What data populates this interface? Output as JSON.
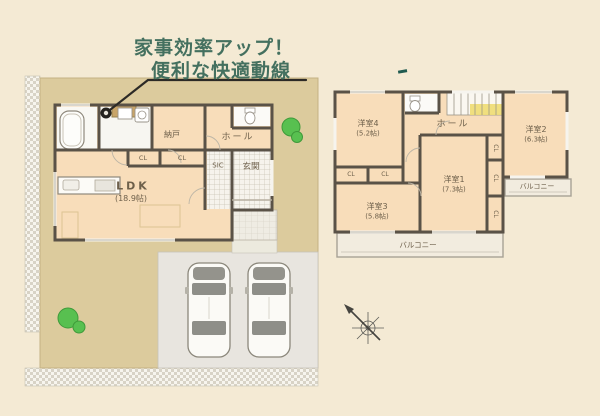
{
  "callout": {
    "line1": "家事効率アップ！",
    "line2": "便利な快適動線"
  },
  "floor1": {
    "rooms": {
      "ldk": {
        "label": "LDK",
        "size": "(18.9帖)"
      },
      "nando": {
        "label": "納戸"
      },
      "hall": {
        "label": "ホール"
      },
      "sic": {
        "label": "SIC"
      },
      "genkan": {
        "label": "玄関"
      },
      "closet_a": "CL",
      "closet_b": "CL"
    },
    "parking_cars": 2
  },
  "floor2": {
    "rooms": {
      "room1": {
        "label": "洋室1",
        "size": "(7.3帖)"
      },
      "room2": {
        "label": "洋室2",
        "size": "(6.3帖)"
      },
      "room3": {
        "label": "洋室3",
        "size": "(5.8帖)"
      },
      "room4": {
        "label": "洋室4",
        "size": "(5.2帖)"
      },
      "hall": {
        "label": "ホール"
      },
      "balcony_south": "バルコニー",
      "balcony_east": "バルコニー",
      "closets": [
        "CL",
        "CL",
        "CL",
        "CL",
        "CL"
      ]
    }
  },
  "colors": {
    "background": "#f4ead4",
    "site_ground": "#dccb9d",
    "room_fill": "#f8ddba",
    "wall": "#5a5247",
    "callout_text": "#44705f",
    "driveway": "#e8e5df",
    "tile": "#f6f3ec",
    "greenery": "#58c050",
    "stairs_highlight": "#eedb72"
  }
}
